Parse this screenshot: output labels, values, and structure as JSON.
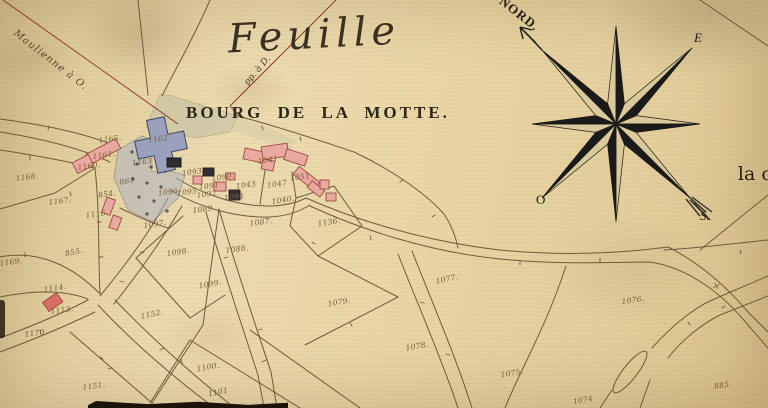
{
  "titles": {
    "sheet_title": "Feuille",
    "place_title": "BOURG DE LA MOTTE."
  },
  "notes": {
    "road_note_nw": "Maulienne à O.",
    "alignment_note": "pp. à D.",
    "right_edge_text": "la c",
    "survey_mark": "×"
  },
  "compass": {
    "north_label": "NORD.",
    "east_label": "E",
    "west_label": "O",
    "south_label": "S."
  },
  "colors": {
    "paper": "#e8d6a8",
    "line": "#6e5b3c",
    "red_line": "#8d3b2c",
    "building_pink": "#e9a8a0",
    "building_dark": "#342e33",
    "church_blue": "#9aa0bd",
    "cemetery_blue": "#aab0c4",
    "ink": "#2c2619",
    "number_ink": "#7b5a38",
    "wash_green": "#c8c3a6"
  },
  "map": {
    "parcels": [
      {
        "label": "1165.",
        "x": 110,
        "y": 139,
        "rot": -8
      },
      {
        "label": "1161.",
        "x": 104,
        "y": 155,
        "rot": -8
      },
      {
        "label": "1160.",
        "x": 89,
        "y": 166,
        "rot": -8
      },
      {
        "label": "861",
        "x": 127,
        "y": 181,
        "rot": -8
      },
      {
        "label": "854.",
        "x": 107,
        "y": 194,
        "rot": -8
      },
      {
        "label": "1116.",
        "x": 97,
        "y": 214,
        "rot": -8
      },
      {
        "label": "1167.",
        "x": 60,
        "y": 201,
        "rot": -8
      },
      {
        "label": "1168.",
        "x": 27,
        "y": 177,
        "rot": -8
      },
      {
        "label": "855.",
        "x": 74,
        "y": 252,
        "rot": -10
      },
      {
        "label": "1169.",
        "x": 11,
        "y": 262,
        "rot": -8
      },
      {
        "label": "1114.",
        "x": 55,
        "y": 288,
        "rot": -8
      },
      {
        "label": "1113.",
        "x": 62,
        "y": 310,
        "rot": -8
      },
      {
        "label": "1170.",
        "x": 36,
        "y": 333,
        "rot": -8
      },
      {
        "label": "1151.",
        "x": 94,
        "y": 386,
        "rot": -8
      },
      {
        "label": "1152.",
        "x": 152,
        "y": 314,
        "rot": -12
      },
      {
        "label": "1100.",
        "x": 208,
        "y": 367,
        "rot": -10
      },
      {
        "label": "1101",
        "x": 218,
        "y": 392,
        "rot": -10
      },
      {
        "label": "1099.",
        "x": 210,
        "y": 284,
        "rot": -10
      },
      {
        "label": "1098.",
        "x": 178,
        "y": 252,
        "rot": -8
      },
      {
        "label": "1097.",
        "x": 155,
        "y": 224,
        "rot": -8
      },
      {
        "label": "1088.",
        "x": 237,
        "y": 249,
        "rot": -8
      },
      {
        "label": "1089.",
        "x": 204,
        "y": 209,
        "rot": -8
      },
      {
        "label": "1087.",
        "x": 261,
        "y": 222,
        "rot": -8
      },
      {
        "label": "1090.",
        "x": 223,
        "y": 177,
        "rot": -8
      },
      {
        "label": "1091",
        "x": 209,
        "y": 186,
        "rot": -8
      },
      {
        "label": "1092.",
        "x": 208,
        "y": 194,
        "rot": -8
      },
      {
        "label": "1093",
        "x": 192,
        "y": 172,
        "rot": -8
      },
      {
        "label": "1094",
        "x": 234,
        "y": 197,
        "rot": -8
      },
      {
        "label": "1095",
        "x": 187,
        "y": 192,
        "rot": -8
      },
      {
        "label": "1096",
        "x": 168,
        "y": 192,
        "rot": -8
      },
      {
        "label": "1162",
        "x": 158,
        "y": 139,
        "rot": -8
      },
      {
        "label": "1163",
        "x": 142,
        "y": 162,
        "rot": -8
      },
      {
        "label": "1041",
        "x": 268,
        "y": 160,
        "rot": -8
      },
      {
        "label": "1043",
        "x": 246,
        "y": 185,
        "rot": -8
      },
      {
        "label": "1047",
        "x": 277,
        "y": 184,
        "rot": -8
      },
      {
        "label": "1051",
        "x": 300,
        "y": 177,
        "rot": -8
      },
      {
        "label": "1040.",
        "x": 283,
        "y": 200,
        "rot": -8
      },
      {
        "label": "1136.",
        "x": 329,
        "y": 222,
        "rot": -10
      },
      {
        "label": "1077.",
        "x": 447,
        "y": 279,
        "rot": -12
      },
      {
        "label": "1079.",
        "x": 339,
        "y": 302,
        "rot": -10
      },
      {
        "label": "1078.",
        "x": 417,
        "y": 346,
        "rot": -10
      },
      {
        "label": "1075.",
        "x": 512,
        "y": 373,
        "rot": -10
      },
      {
        "label": "1076.",
        "x": 633,
        "y": 300,
        "rot": -8
      },
      {
        "label": "1074",
        "x": 583,
        "y": 400,
        "rot": -10
      },
      {
        "label": "885.",
        "x": 723,
        "y": 385,
        "rot": -10
      }
    ]
  }
}
